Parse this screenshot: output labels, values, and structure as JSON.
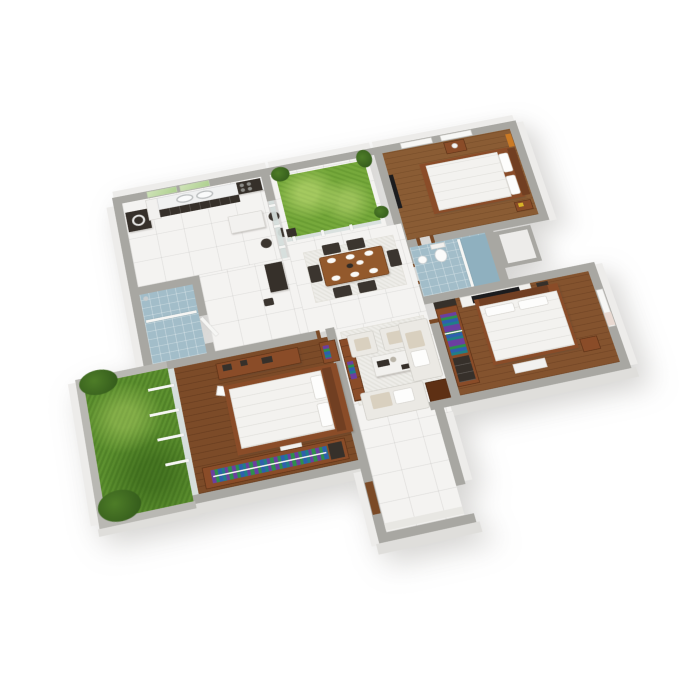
{
  "image_type": "3D isometric cutaway floor plan rendering of a three-bedroom house, white background, no visible text",
  "view": {
    "projection": "isometric top-down 3D cutaway",
    "background": "#ffffff"
  },
  "colors": {
    "wall": "#a8a7a2",
    "wallIn": "#b9b8b3",
    "face": "#edecea",
    "faceShade": "#dfdedb",
    "tile": "#f4f3f1",
    "tileLine": "rgba(120,120,115,0.14)",
    "wood1": "#8a5c34",
    "wood2": "#7c4b28",
    "wood3": "#84532e",
    "grassC": "#76a93b",
    "grassG": "#5e9230",
    "bath": "#a2bdc9",
    "bathD": "#8fb0bf",
    "glass": "#d7e0dd",
    "dark": "#36302a",
    "counter": "#f0f1f1",
    "table": "#93592c",
    "chair": "#3b352f",
    "sofa": "#ebe9e4",
    "cushion": "#d9d0bf",
    "rug": "#eeede9",
    "bedding": "#f3f2ef",
    "frame": "#8a4c28",
    "headboard": "#713f22",
    "tv": "#1c1c1e",
    "panel": "#f2f1ee",
    "art": "#cb7a24",
    "door": "#7b4a26",
    "plant1": "#4e7d28",
    "plant2": "#2f5519",
    "white": "#f2f1ef",
    "cl1": "#6b3fa0",
    "cl2": "#2e8f4e",
    "cl3": "#2f5fae",
    "cl4": "#207f86",
    "yellow": "#d8b428",
    "windowTint": "#e9d9d1"
  },
  "rooms": {
    "kitchen": {
      "name": "Kitchen",
      "floor": "white tile",
      "items": [
        "counter with double sink",
        "cooktop",
        "washing machine",
        "white island",
        "bar stools",
        "green window panes"
      ]
    },
    "courtyard": {
      "name": "Courtyard garden",
      "floor": "grass",
      "items": [
        "glass fence",
        "potted plants"
      ]
    },
    "bedroom1": {
      "name": "Bedroom 1",
      "floor": "wood",
      "items": [
        "double bed",
        "nightstands",
        "orange wall art",
        "dark wall panel",
        "windows"
      ]
    },
    "bathroom1": {
      "name": "Shower room",
      "floor": "blue tile",
      "items": [
        "walk-in shower",
        "glass screen",
        "door"
      ]
    },
    "bathroom2": {
      "name": "Bathroom",
      "floor": "blue tile",
      "items": [
        "toilet",
        "wash basin",
        "shower screen",
        "storage niche"
      ]
    },
    "dining": {
      "name": "Dining area",
      "floor": "white tile",
      "items": [
        "wooden table",
        "six chairs",
        "place settings",
        "area rug"
      ]
    },
    "living": {
      "name": "Living room",
      "floor": "white tile",
      "items": [
        "two armchairs",
        "two sofas",
        "coffee table",
        "side table",
        "bookcase console",
        "area rug"
      ]
    },
    "bedroom2": {
      "name": "Bedroom 2",
      "floor": "wood",
      "items": [
        "double bed",
        "open wardrobe with clothes",
        "TV wall panel",
        "nightstand",
        "window"
      ]
    },
    "master": {
      "name": "Master bedroom",
      "floor": "wood",
      "items": [
        "double bed",
        "desk unit",
        "wardrobe with clothes",
        "ottoman",
        "sliding glass doors"
      ]
    },
    "garden": {
      "name": "Side garden",
      "floor": "grass",
      "items": [
        "shrubs",
        "low boundary wall",
        "door rails"
      ]
    },
    "entry": {
      "name": "Entry hall",
      "floor": "white tile",
      "items": [
        "front door"
      ]
    }
  }
}
